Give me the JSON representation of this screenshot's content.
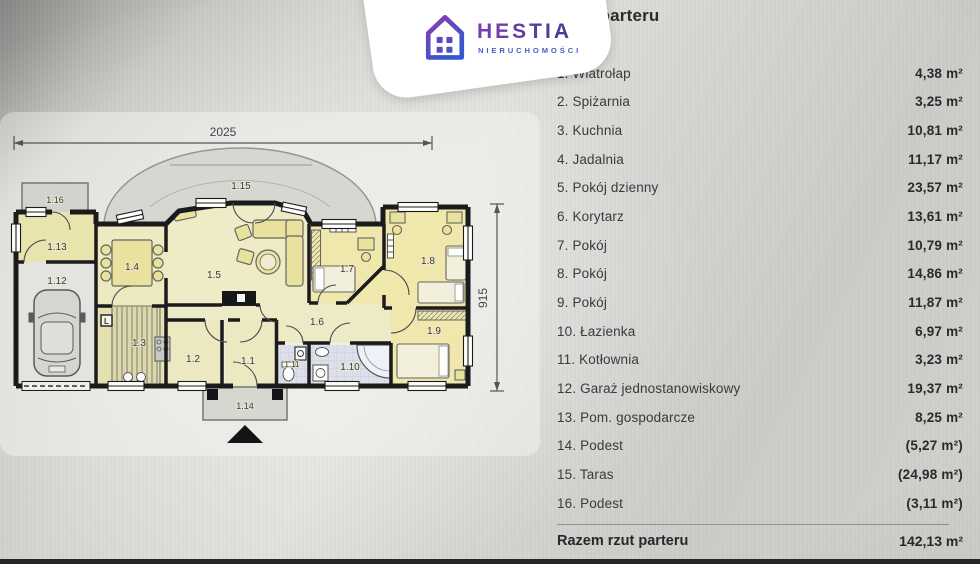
{
  "header": {
    "title": "Rzut parteru"
  },
  "logo": {
    "brand": "HESTIA",
    "subtitle": "NIERUCHOMOŚCI"
  },
  "floor_plan": {
    "dim_width": "2025",
    "dim_height": "915",
    "stair_mark": "L",
    "tags": [
      "1.1",
      "1.2",
      "1.3",
      "1.4",
      "1.5",
      "1.6",
      "1.7",
      "1.8",
      "1.9",
      "1.10",
      "1.11",
      "1.12",
      "1.13",
      "1.14",
      "1.15",
      "1.16"
    ]
  },
  "legend": {
    "items": [
      {
        "name": "1. Wiatrołap",
        "area": "4,38 m²"
      },
      {
        "name": "2. Spiżarnia",
        "area": "3,25 m²"
      },
      {
        "name": "3. Kuchnia",
        "area": "10,81 m²"
      },
      {
        "name": "4. Jadalnia",
        "area": "11,17 m²"
      },
      {
        "name": "5. Pokój dzienny",
        "area": "23,57 m²"
      },
      {
        "name": "6. Korytarz",
        "area": "13,61 m²"
      },
      {
        "name": "7. Pokój",
        "area": "10,79 m²"
      },
      {
        "name": "8. Pokój",
        "area": "14,86 m²"
      },
      {
        "name": "9. Pokój",
        "area": "11,87 m²"
      },
      {
        "name": "10. Łazienka",
        "area": "6,97 m²"
      },
      {
        "name": "11. Kotłownia",
        "area": "3,23 m²"
      },
      {
        "name": "12. Garaż jednostanowiskowy",
        "area": "19,37 m²"
      },
      {
        "name": "13. Pom. gospodarcze",
        "area": "8,25 m²"
      },
      {
        "name": "14. Podest",
        "area": "(5,27 m²)"
      },
      {
        "name": "15. Taras",
        "area": "(24,98 m²)"
      },
      {
        "name": "16. Podest",
        "area": "(3,11 m²)"
      }
    ],
    "total_label": "Razem rzut parteru",
    "total_value": "142,13 m²"
  }
}
